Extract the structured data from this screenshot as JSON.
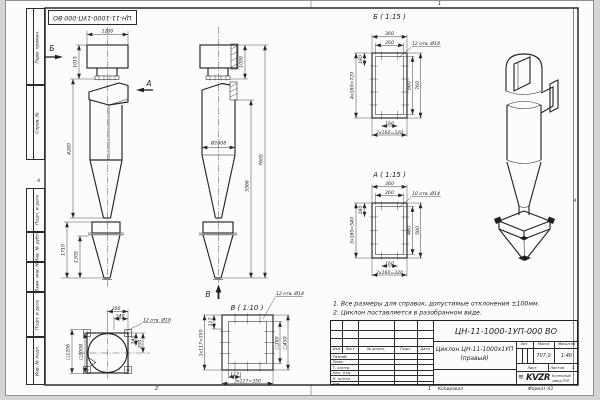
{
  "colors": {
    "line": "#262626",
    "sheet": "#fcfcfc",
    "background": "#d4d5d6"
  },
  "doc_box_top": {
    "number": "ЦН-11-1000-1УП-000 ВО"
  },
  "margin_stamps": {
    "items": [
      "Перв. примен.",
      "Справ. №",
      "Подп. и дата",
      "Инв. № дубл.",
      "Взам. инв. №",
      "Подп. и дата",
      "Инв. № подл."
    ]
  },
  "zone_markers": {
    "top": "1",
    "bottom_left": "2",
    "bottom_right": "1",
    "left": "А",
    "right": "А"
  },
  "views": {
    "front": {
      "dir_label_b": "Б",
      "dir_label_a": "А",
      "dims": {
        "w_top": "1200",
        "h_inlet": "1015",
        "h_body": "4280",
        "h_bin": "1710",
        "h_bin_cone": "1305"
      }
    },
    "side": {
      "dir_label_v": "В",
      "dims": {
        "dia": "Ø1008",
        "h_top": "1059",
        "h_mid": "5566",
        "h_total": "7605"
      }
    },
    "detail_b": {
      "title": "Б ( 1:15 )",
      "holes_note": "12 отв. Ø14",
      "dims": {
        "top_outer": "360",
        "top_inner": "260",
        "left_step": "180",
        "left_total": "4x180=720",
        "right_inner": "660",
        "right_outer": "760",
        "bottom_step": "160",
        "bottom_total": "2x160=320"
      }
    },
    "detail_a": {
      "title": "А ( 1:15 )",
      "holes_note": "10 отв. Ø14",
      "dims": {
        "top_outer": "360",
        "top_inner": "260",
        "left_step": "180",
        "left_total": "3x180=540",
        "right_inner": "480",
        "right_outer": "580",
        "bottom_step": "160",
        "bottom_total": "2x160=320"
      }
    },
    "detail_v": {
      "title": "В ( 1:10 )",
      "holes_note": "12 отв. Ø14",
      "dims": {
        "left_step": "117",
        "left_total": "3x117=350",
        "right_inner": "□380",
        "right_outer": "□450",
        "bottom_step": "117",
        "bottom_total": "3x117=350"
      }
    },
    "top_view": {
      "holes_note": "12 отв. Ø18",
      "dims": {
        "off_200": "200",
        "off_140": "140",
        "right_140": "140",
        "right_200": "200",
        "sq_inner": "□1008",
        "sq_outer": "□1206"
      }
    }
  },
  "notes": {
    "items": [
      "1. Все размеры для справок, допустимые отклонения ±100мм.",
      "2. Циклон поставляется в разобранном виде."
    ]
  },
  "title_block": {
    "doc_number": "ЦН-11-1000-1УП-000 ВО",
    "name_line1": "Циклон ЦН-11-1000х1УП",
    "name_line2": "(правый)",
    "header": {
      "izm": "Изм",
      "list": "Лист",
      "doc": "№ докум.",
      "podp": "Подп.",
      "data": "Дата"
    },
    "rows": {
      "items": [
        "Разраб.",
        "Пров.",
        "Т. контр.",
        "Нач. отд.",
        "Н. контр.",
        "Утв."
      ]
    },
    "lit_label": "Лит.",
    "mass_label": "Масса",
    "scale_label": "Масштаб",
    "mass": "707,0",
    "scale": "1:40",
    "sheet_label": "Лист",
    "sheets_label": "Листов",
    "sheets_value": "1",
    "logo": "KVZR",
    "logo_glyph": "≋",
    "company_line1": "Котельный",
    "company_line2": "завод РЭП",
    "footer_copy": "Копировал",
    "footer_format": "Формат А3"
  }
}
